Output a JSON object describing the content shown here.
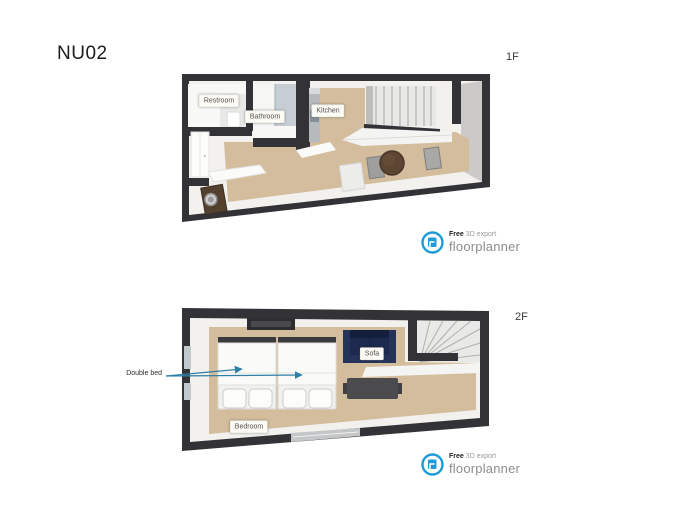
{
  "title": "NU02",
  "floor1": {
    "label": "1F",
    "rooms": {
      "restroom": "Restroom",
      "bathroom": "Bathroom",
      "kitchen": "Kitchen"
    }
  },
  "floor2": {
    "label": "2F",
    "rooms": {
      "sofa": "Sofa",
      "bedroom": "Bedroom"
    },
    "annotations": {
      "double_bed": "Double bed"
    }
  },
  "branding": {
    "free": "Free",
    "export_label": "3D export",
    "brand": "floorplanner",
    "brand_color": "#1e9bd7"
  },
  "colors": {
    "wall": "#333236",
    "floor": "#d3bd9c",
    "sofa": "#1d2a4f",
    "arrow": "#2f7fa6",
    "stairs": "#e8e8e6"
  }
}
